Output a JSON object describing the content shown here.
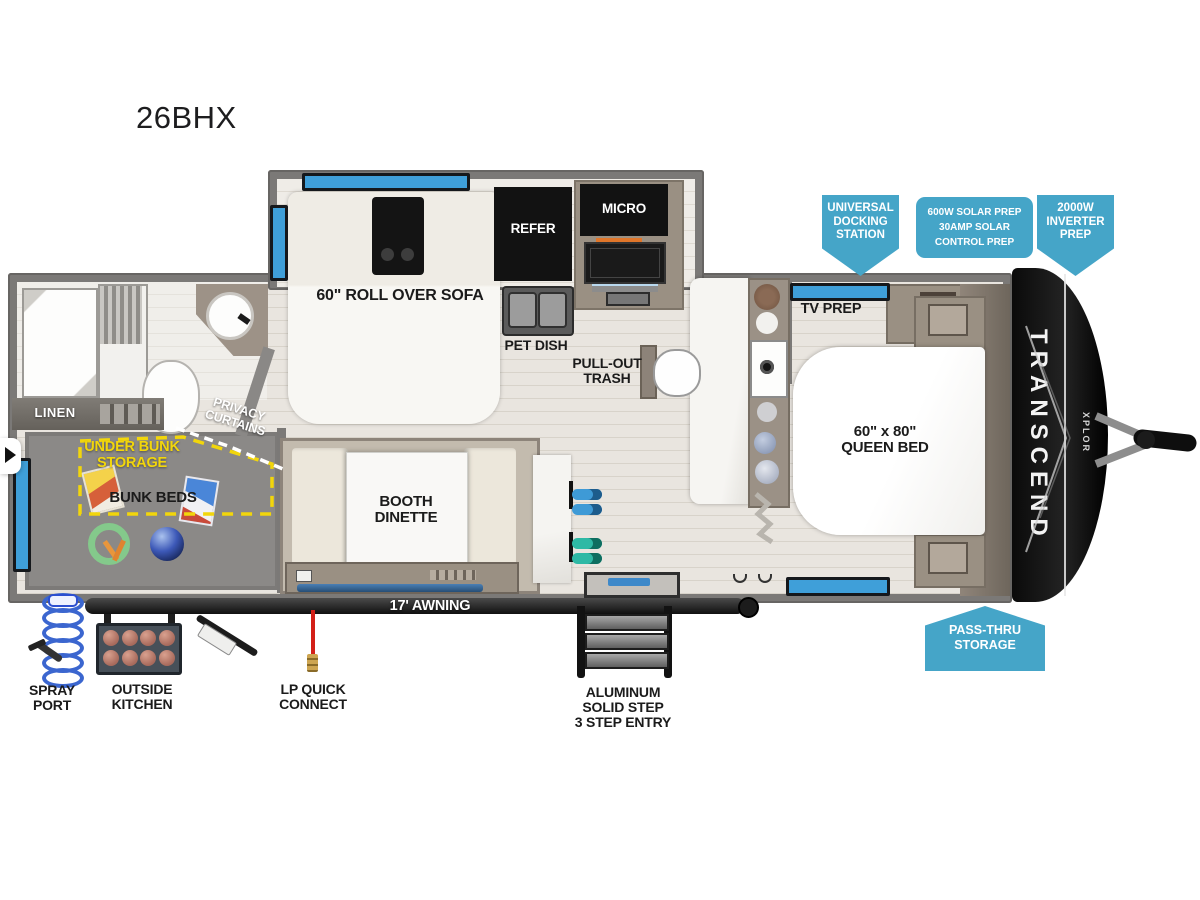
{
  "title": "26BHX",
  "brand": {
    "name": "TRANSCEND",
    "sub": "XPLOR"
  },
  "callouts": {
    "universal_docking": "UNIVERSAL\nDOCKING\nSTATION",
    "solar": "600W SOLAR PREP\n30AMP SOLAR\nCONTROL PREP",
    "inverter": "2000W\nINVERTER\nPREP",
    "pass_thru": "PASS-THRU\nSTORAGE"
  },
  "labels": {
    "linen": "LINEN",
    "privacy_curtains": "PRIVACY\nCURTAINS",
    "under_bunk_storage": "UNDER BUNK\nSTORAGE",
    "bunk_beds": "BUNK BEDS",
    "sofa": "60\" ROLL OVER SOFA",
    "refer": "REFER",
    "micro": "MICRO",
    "pet_dish": "PET DISH",
    "pull_out_trash": "PULL-OUT\nTRASH",
    "tv_prep": "TV PREP",
    "queen_bed": "60\" x 80\"\nQUEEN BED",
    "booth_dinette": "BOOTH\nDINETTE",
    "awning": "17' AWNING",
    "spray_port": "SPRAY\nPORT",
    "outside_kitchen": "OUTSIDE\nKITCHEN",
    "lp_quick_connect": "LP QUICK\nCONNECT",
    "entry_steps": "ALUMINUM\nSOLID STEP\n3 STEP ENTRY"
  },
  "colors": {
    "callout_blue": "#45a5c8",
    "window_blue": "#3f9fd9",
    "storage_yellow": "#f2d60b",
    "lp_red": "#d32018",
    "chair_blue": "#3e9ad6",
    "chair_teal": "#2eb9a5"
  }
}
